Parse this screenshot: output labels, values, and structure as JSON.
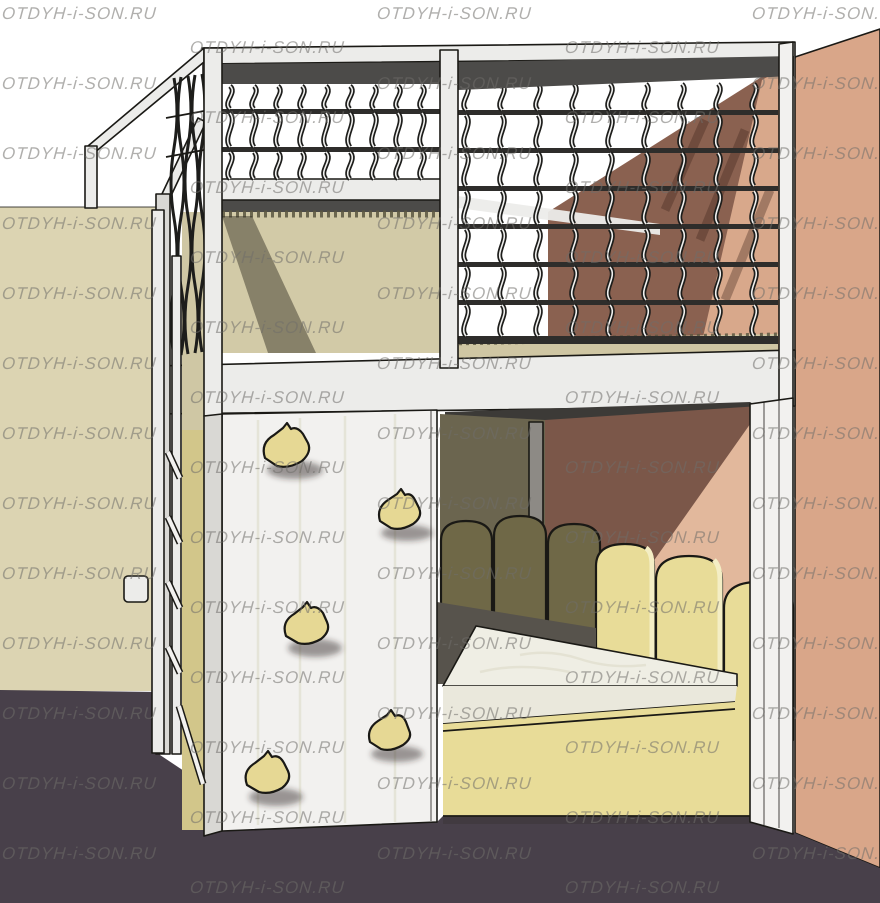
{
  "watermark": {
    "text": "OTDYH-i-SON.RU",
    "columns": [
      2,
      190,
      377,
      565,
      752
    ],
    "row_start_a": 4,
    "row_start_b": 38,
    "row_period": 70,
    "rows": 13
  },
  "colors": {
    "bg": "#ffffff",
    "wall_left": "#dcd4b2",
    "wall_right": "#d9a689",
    "behind_net_brown": "#8a6150",
    "behind_net_lit": "#d8a88b",
    "underdeck_brown": "#7b5749",
    "underdeck_lit": "#e2b89c",
    "floor": "#48404a",
    "white": "#ececea",
    "white_bright": "#f2f1ef",
    "white_shade": "#d9d8d4",
    "dark_band": "#4c4b49",
    "rail": "#2e2d2b",
    "baluster": "#1d1d1b",
    "baluster_hl": "#f0f0ee",
    "carpet": "#cfc6a3",
    "carpet_edge": "#5a5640",
    "halfwall": "#d2caa7",
    "olive_panel": "#6b654f",
    "post_gray": "#8d8a85",
    "picket_dark": "#6f6847",
    "picket_light": "#e8dc98",
    "picket_hl": "#f4eec5",
    "mattress_top": "#efeee4",
    "mattress_front": "#eae8dc",
    "grain": "#dbd8c4",
    "base_yellow": "#e8dc98",
    "hold": "#e6d894",
    "underbed": "#57534c",
    "gap_dark": "#3a342f",
    "ceiling_dark": "#3c3a37",
    "behind_ladder_beige": "#cfc7a4",
    "behind_ladder_yellow": "#d2c68a",
    "outline": "#1a1915",
    "shadow_soft": "rgba(45,40,30,0.45)",
    "watermark": "rgba(112,109,106,0.55)"
  }
}
